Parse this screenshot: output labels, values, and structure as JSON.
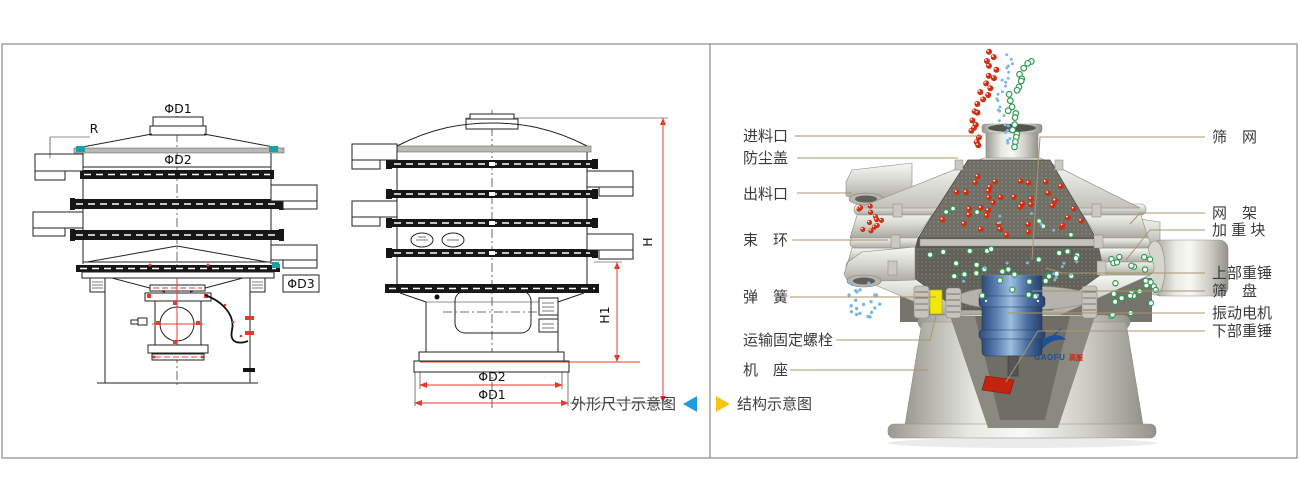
{
  "window": {
    "width": 1300,
    "height": 482,
    "background": "#ffffff",
    "border_color": "#8a8a8a"
  },
  "left_panel": {
    "caption": "外形尺寸示意图",
    "arrow_icon": "left-triangle",
    "arrow_color": "#1e9be2",
    "colors": {
      "drawing": "#222222",
      "dimension": "#e8392b",
      "accent": "#17a3a3"
    },
    "dims": {
      "phiD1": "ΦD1",
      "r": "R",
      "phiD2": "ΦD2",
      "phiD3": "ΦD3",
      "h": "H",
      "h1": "H1",
      "phiD2_bottom": "ΦD2",
      "phiD1_bottom": "ΦD1"
    }
  },
  "right_panel": {
    "caption": "结构示意图",
    "arrow_icon": "right-triangle",
    "arrow_color": "#f6c318",
    "leader_color": "#a8956b",
    "labels_left": [
      {
        "text": "进料口"
      },
      {
        "text": "防尘盖"
      },
      {
        "text": "出料口"
      },
      {
        "text": "束　环"
      },
      {
        "text": "弹　簧"
      },
      {
        "text": "运输固定螺栓"
      },
      {
        "text": "机　座"
      }
    ],
    "labels_right": [
      {
        "text": "筛　网"
      },
      {
        "text": "网　架"
      },
      {
        "text": "加 重 块"
      },
      {
        "text": "上部重锤"
      },
      {
        "text": "筛　盘"
      },
      {
        "text": "振动电机"
      },
      {
        "text": "下部重锤"
      }
    ],
    "logo": {
      "text": "GAOFU",
      "suffix": "高服",
      "color": "#1e4f9a",
      "suffix_color": "#cc2211"
    },
    "particle_colors": {
      "red": "#cf3014",
      "green": "#2e9b52",
      "blue": "#7db5e3"
    },
    "machine_colors": {
      "motor_blue": "#5c82b5",
      "hammer_red": "#c32410",
      "bolt_yellow": "#f2e70a"
    }
  }
}
